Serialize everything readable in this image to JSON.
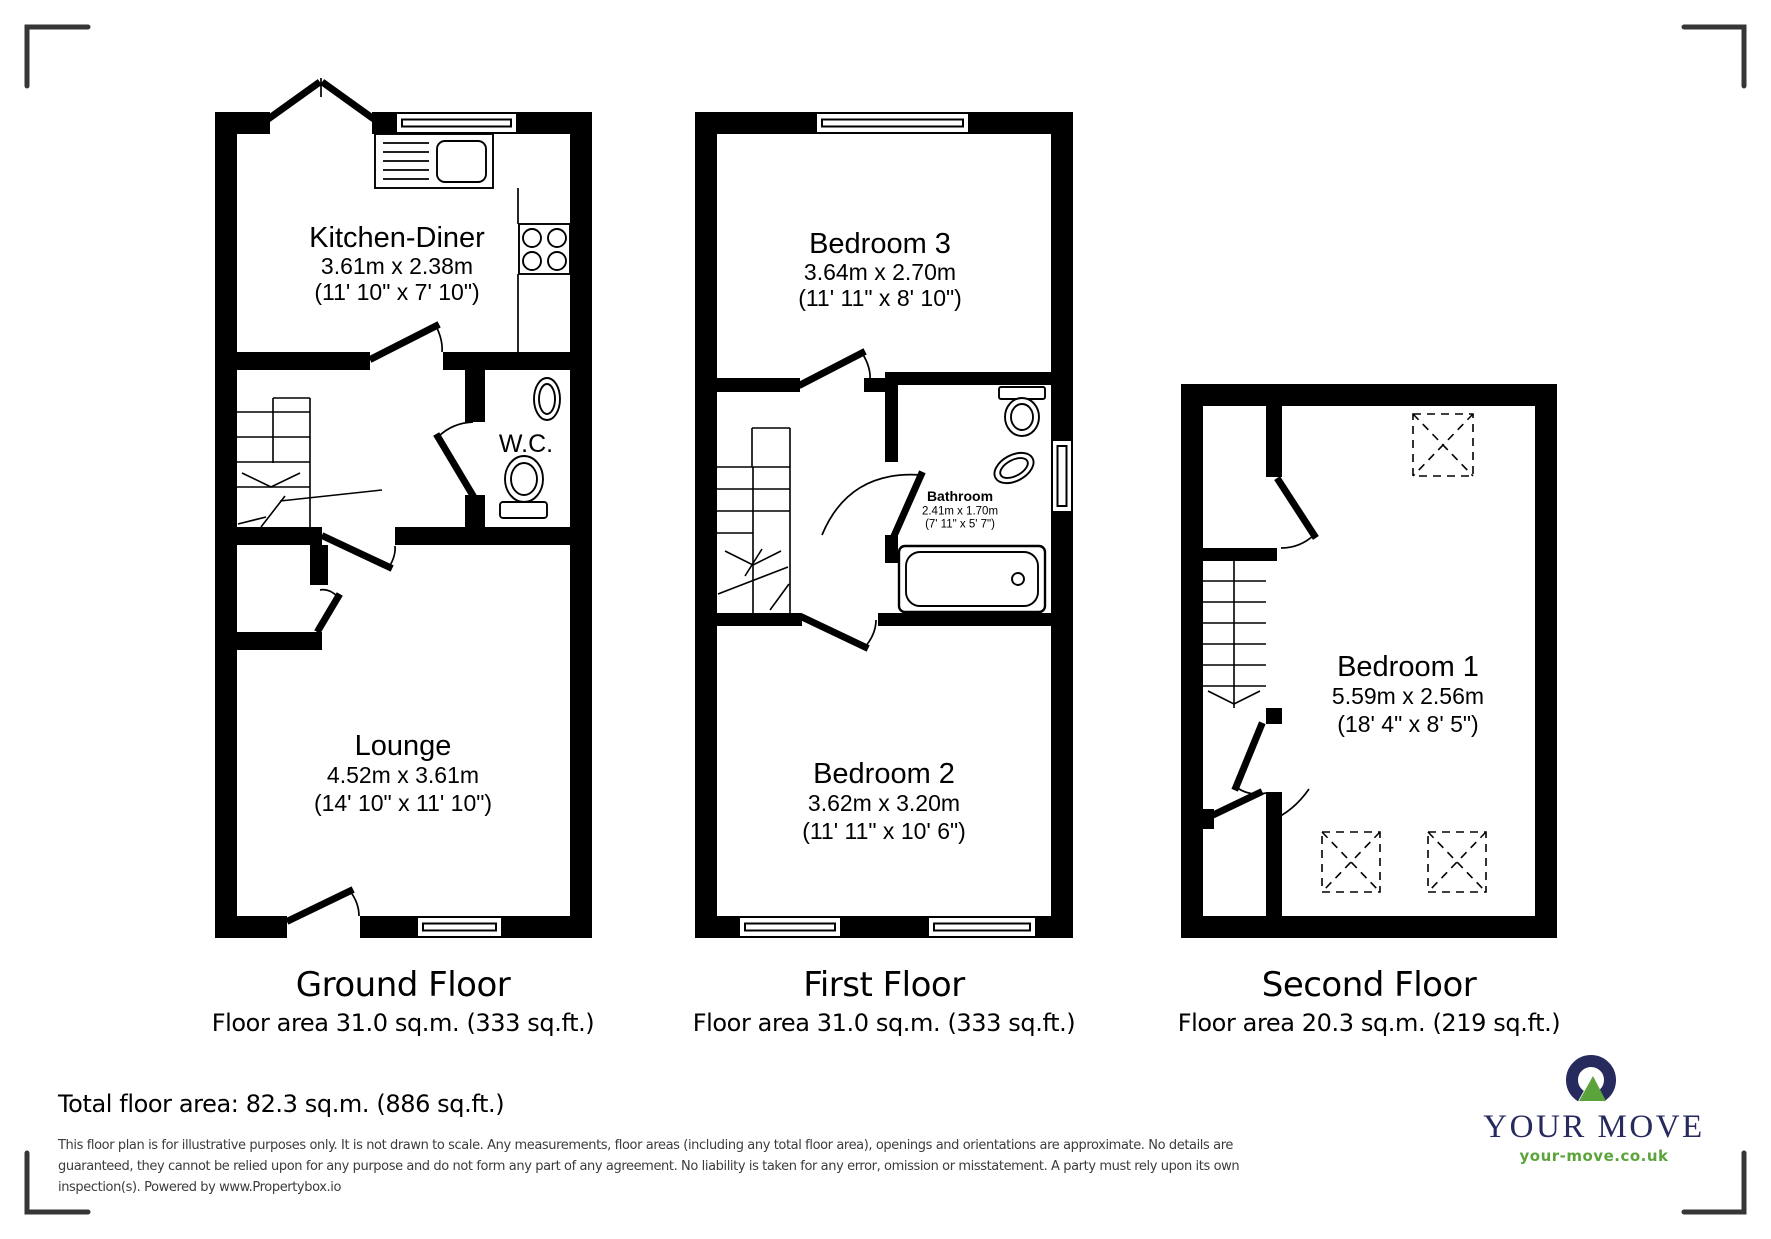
{
  "colors": {
    "wall": "#000000",
    "bracket": "#363636",
    "logo_navy": "#262a5c",
    "logo_green": "#5ba43c",
    "disclaimer_text": "#3c3c3c"
  },
  "floors": {
    "ground": {
      "title": "Ground Floor",
      "area": "Floor area 31.0 sq.m. (333 sq.ft.)"
    },
    "first": {
      "title": "First Floor",
      "area": "Floor area 31.0 sq.m. (333 sq.ft.)"
    },
    "second": {
      "title": "Second Floor",
      "area": "Floor area 20.3 sq.m. (219 sq.ft.)"
    }
  },
  "rooms": {
    "kitchen": {
      "name": "Kitchen-Diner",
      "metric": "3.61m x 2.38m",
      "imperial": "(11' 10\" x 7' 10\")"
    },
    "wc": {
      "name": "W.C."
    },
    "lounge": {
      "name": "Lounge",
      "metric": "4.52m x 3.61m",
      "imperial": "(14' 10\" x 11' 10\")"
    },
    "bedroom3": {
      "name": "Bedroom 3",
      "metric": "3.64m x 2.70m",
      "imperial": "(11' 11\" x 8' 10\")"
    },
    "bathroom": {
      "name": "Bathroom",
      "metric": "2.41m x 1.70m",
      "imperial": "(7' 11\" x 5' 7\")"
    },
    "bedroom2": {
      "name": "Bedroom 2",
      "metric": "3.62m x 3.20m",
      "imperial": "(11' 11\" x 10' 6\")"
    },
    "bedroom1": {
      "name": "Bedroom 1",
      "metric": "5.59m x 2.56m",
      "imperial": "(18' 4\" x 8' 5\")"
    }
  },
  "summary": {
    "total": "Total floor area: 82.3 sq.m. (886 sq.ft.)"
  },
  "disclaimer": {
    "line1": "This floor plan is for illustrative purposes only. It is not drawn to scale. Any measurements, floor areas (including any total floor area), openings and orientations are approximate. No details are",
    "line2": "guaranteed, they cannot be relied upon for any purpose and do not form any part of any agreement. No liability is taken for any error, omission or misstatement. A party must rely upon its own",
    "line3": "inspection(s). Powered by www.Propertybox.io"
  },
  "logo": {
    "brand": "YOUR MOVE",
    "url": "your-move.co.uk"
  }
}
